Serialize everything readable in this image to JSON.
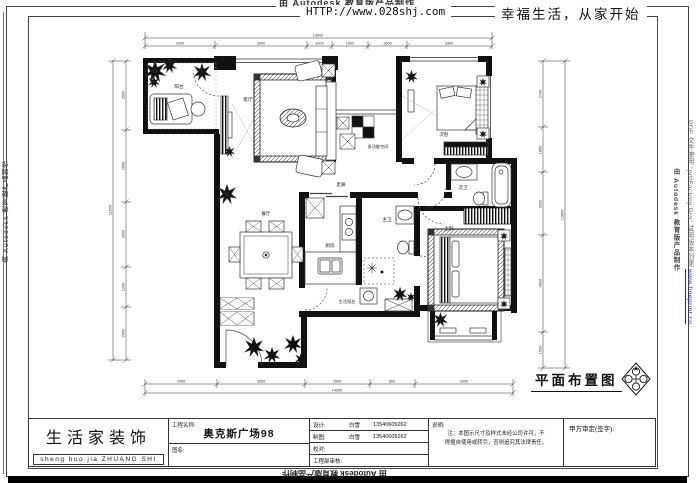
{
  "header": {
    "watermark": "由 Autodesk 教育版产品制作",
    "url": "HTTP://www.028shj.com",
    "slogan": "幸福生活，从家开始"
  },
  "rooms": {
    "balcony": "阳台",
    "living": "客厅",
    "multi": "多功能空间",
    "bedroom2": "次卧",
    "bath2": "次卫",
    "corridor": "走廊",
    "dining": "餐厅",
    "kitchen": "厨房",
    "service_balcony": "生活阳台",
    "master_bath": "主卫",
    "master_bedroom": "主卧"
  },
  "stamp": {
    "title": "平面布置图"
  },
  "dimensions": {
    "top": {
      "total": "13600",
      "segments": [
        "2900",
        "3500",
        "1000",
        "1500",
        "1500",
        "3300"
      ]
    },
    "bottom": {
      "total": "14500",
      "segments": [
        "2900",
        "3500",
        "2500",
        "800",
        "3900"
      ]
    },
    "left": {
      "total": "11900",
      "segments": [
        "2500",
        "2900",
        "3300",
        "1200",
        "2000"
      ]
    },
    "right": {
      "total": "12650",
      "segments": [
        "2700",
        "1850",
        "2600",
        "4000",
        "1500"
      ]
    }
  },
  "title_block": {
    "company": "生活家装饰",
    "company_pinyin": "sheng huo jia ZHUANG SHI",
    "project_label": "工程名称:",
    "project_name": "奥克斯广场98",
    "drawing_label": "图名:",
    "rows": [
      {
        "label": "设计:",
        "name": "白雪",
        "phone": "13540609262"
      },
      {
        "label": "制图:",
        "name": "白雪",
        "phone": "13540609262"
      },
      {
        "label": "校对:",
        "name": "",
        "phone": ""
      },
      {
        "label": "工程部审核:",
        "name": "",
        "phone": ""
      }
    ],
    "note_label": "说明:",
    "note_line1": "注：本图示尺寸及样式未经公司许可，不",
    "note_line2": "得擅自使用或转引，否则追究其法律责任。",
    "sign_label": "甲方审定(签字):"
  },
  "watermarks": {
    "right_autodesk": "由 Autodesk 教育版产品制作",
    "right_pdf": "PDF 文件使用 \"pdfFactory Pro\" 试用版本创建",
    "right_pdf_url": "www.fineprint.cn",
    "left_autodesk": "由 Autodesk 教育版产品制作",
    "bottom_autodesk": "由 Autodesk 教育版产品制作"
  },
  "colors": {
    "link_blue": "#2222cc",
    "line": "#111111"
  }
}
